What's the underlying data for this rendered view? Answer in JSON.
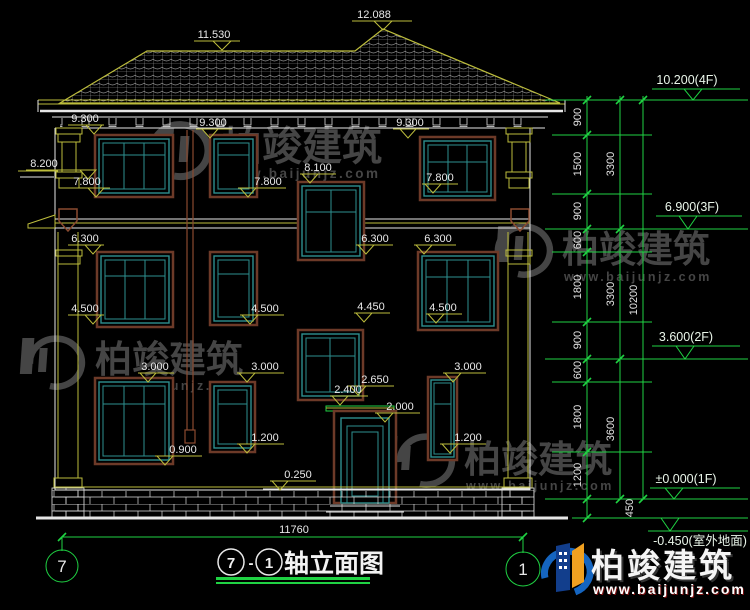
{
  "brand": {
    "name": "柏竣建筑",
    "url": "www.baijunjz.com"
  },
  "drawing_title": {
    "axis_left": "7",
    "separator": "-",
    "axis_right": "1",
    "text": "轴立面图"
  },
  "axis_bubbles": {
    "left": "7",
    "right": "1"
  },
  "span_dimension": "11760",
  "annotations": [
    "12.088",
    "11.530",
    "9.300",
    "9.300",
    "9.300",
    "8.200",
    "7.800",
    "7.800",
    "8.100",
    "7.800",
    "6.300",
    "6.300",
    "6.300",
    "4.500",
    "4.500",
    "4.450",
    "4.500",
    "3.000",
    "3.000",
    "3.000",
    "2.650",
    "2.400",
    "2.000",
    "1.200",
    "1.200",
    "0.900",
    "0.250"
  ],
  "dim_chains": {
    "inner": [
      "900",
      "1500",
      "900",
      "600",
      "1800",
      "900",
      "600",
      "1800",
      "1200",
      "450"
    ],
    "mid": [
      "3300",
      "3300",
      "3600"
    ],
    "outer": [
      "10200"
    ]
  },
  "floor_levels": [
    "10.200(4F)",
    "6.900(3F)",
    "3.600(2F)",
    "±0.000(1F)",
    "-0.450(室外地面)"
  ]
}
